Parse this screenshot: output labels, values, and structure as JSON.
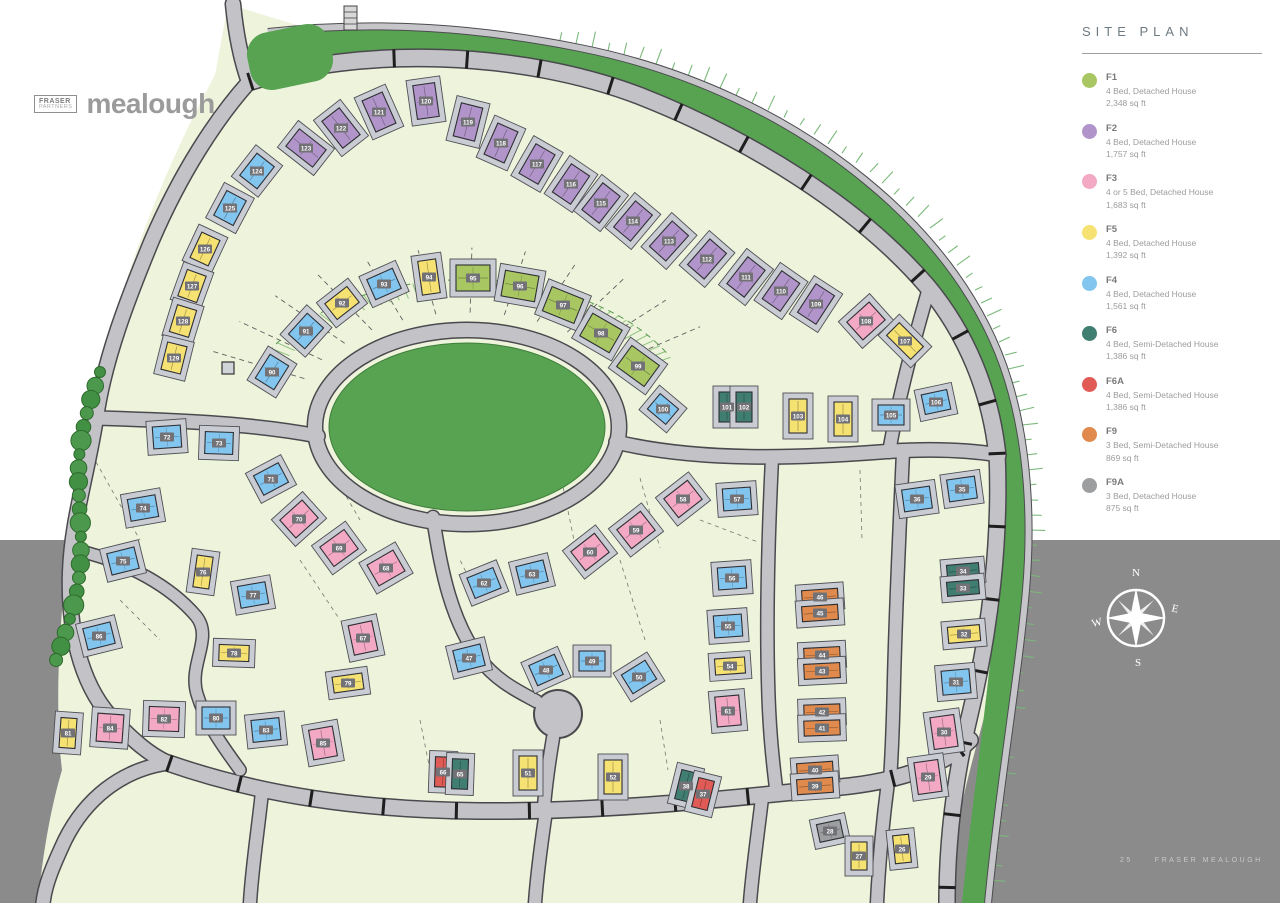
{
  "logo": {
    "box_line1": "FRASER",
    "box_line2": "PARTNERS",
    "name": "mealough"
  },
  "legend": {
    "title": "SITE PLAN",
    "items": [
      {
        "code": "F1",
        "desc": "4 Bed, Detached House",
        "area": "2,348 sq ft",
        "color": "#a8c763"
      },
      {
        "code": "F2",
        "desc": "4 Bed, Detached House",
        "area": "1,757 sq ft",
        "color": "#b195ca"
      },
      {
        "code": "F3",
        "desc": "4 or 5 Bed, Detached House",
        "area": "1,683 sq ft",
        "color": "#f3a9c4"
      },
      {
        "code": "F5",
        "desc": "4 Bed, Detached House",
        "area": "1,392 sq ft",
        "color": "#f6e273"
      },
      {
        "code": "F4",
        "desc": "4 Bed, Detached House",
        "area": "1,561 sq ft",
        "color": "#82c5ef"
      },
      {
        "code": "F6",
        "desc": "4 Bed, Semi-Detached House",
        "area": "1,386 sq ft",
        "color": "#417e72"
      },
      {
        "code": "F6A",
        "desc": "4 Bed, Semi-Detached House",
        "area": "1,386 sq ft",
        "color": "#e05b55"
      },
      {
        "code": "F9",
        "desc": "3 Bed, Semi-Detached House",
        "area": "869 sq ft",
        "color": "#e08b4d"
      },
      {
        "code": "F9A",
        "desc": "3 Bed, Detached House",
        "area": "875 sq ft",
        "color": "#9c9ea0"
      }
    ]
  },
  "compass": {
    "n": "N",
    "e": "E",
    "s": "S",
    "w": "W"
  },
  "footer": {
    "page": "25",
    "text": "FRASER MEALOUGH"
  },
  "colors": {
    "bg_white": "#ffffff",
    "bg_gray": "#8b8b8b",
    "land": "#eef3dc",
    "green": "#57a351",
    "road": "#c3c3c7",
    "road_casing": "#4a4a4e",
    "pad": "#c9cdd3",
    "badge": "#717176",
    "tree": "#4c984c"
  },
  "map": {
    "houses_format": [
      "plot_number",
      "type",
      "x",
      "y",
      "rotation_deg",
      "w_optional",
      "h_optional"
    ],
    "type_sizes": {
      "g": [
        34,
        26
      ],
      "p": [
        22,
        34
      ],
      "k": [
        30,
        24
      ],
      "y": [
        28,
        20
      ],
      "b": [
        28,
        22
      ],
      "t": [
        16,
        30
      ],
      "r": [
        16,
        30
      ],
      "o": [
        36,
        15
      ],
      "a": [
        24,
        18
      ]
    },
    "type_colors": {
      "g": "#a8c763",
      "p": "#b195ca",
      "k": "#f3a9c4",
      "y": "#f6e273",
      "b": "#82c5ef",
      "t": "#417e72",
      "r": "#e05b55",
      "o": "#e08b4d",
      "a": "#9c9ea0"
    },
    "houses": [
      [
        123,
        "p",
        306,
        148,
        -52
      ],
      [
        122,
        "p",
        341,
        128,
        -38
      ],
      [
        121,
        "p",
        379,
        112,
        -24
      ],
      [
        120,
        "p",
        426,
        101,
        -8
      ],
      [
        119,
        "p",
        468,
        122,
        14
      ],
      [
        118,
        "p",
        501,
        143,
        24
      ],
      [
        117,
        "p",
        537,
        164,
        30
      ],
      [
        116,
        "p",
        571,
        184,
        34
      ],
      [
        115,
        "p",
        601,
        203,
        38
      ],
      [
        114,
        "p",
        633,
        221,
        40
      ],
      [
        113,
        "p",
        669,
        241,
        42
      ],
      [
        112,
        "p",
        707,
        259,
        41
      ],
      [
        111,
        "p",
        746,
        277,
        38
      ],
      [
        110,
        "p",
        781,
        291,
        35
      ],
      [
        109,
        "p",
        816,
        304,
        33
      ],
      [
        124,
        "b",
        257,
        171,
        -52
      ],
      [
        125,
        "b",
        230,
        208,
        -62
      ],
      [
        126,
        "y",
        205,
        249,
        -65
      ],
      [
        127,
        "y",
        192,
        286,
        -70
      ],
      [
        128,
        "y",
        183,
        321,
        -73
      ],
      [
        129,
        "y",
        174,
        358,
        -76
      ],
      [
        90,
        "b",
        272,
        372,
        -58
      ],
      [
        91,
        "b",
        306,
        331,
        -48
      ],
      [
        92,
        "y",
        342,
        303,
        -38
      ],
      [
        93,
        "b",
        384,
        284,
        -24
      ],
      [
        94,
        "y",
        429,
        277,
        -8,
        18,
        34
      ],
      [
        95,
        "g",
        473,
        278,
        0
      ],
      [
        96,
        "g",
        520,
        286,
        10
      ],
      [
        97,
        "g",
        563,
        305,
        22
      ],
      [
        98,
        "g",
        601,
        333,
        30
      ],
      [
        99,
        "g",
        638,
        366,
        36
      ],
      [
        100,
        "b",
        663,
        409,
        40,
        24,
        20
      ],
      [
        101,
        "t",
        727,
        407,
        0
      ],
      [
        102,
        "t",
        744,
        407,
        0
      ],
      [
        103,
        "y",
        798,
        416,
        0,
        18,
        34
      ],
      [
        104,
        "y",
        843,
        419,
        0,
        18,
        34
      ],
      [
        105,
        "b",
        891,
        415,
        0,
        26,
        20
      ],
      [
        106,
        "b",
        936,
        402,
        -12,
        26,
        20
      ],
      [
        108,
        "k",
        866,
        321,
        -42
      ],
      [
        107,
        "y",
        905,
        341,
        -45,
        18,
        34
      ],
      [
        36,
        "b",
        917,
        499,
        -8
      ],
      [
        35,
        "b",
        962,
        489,
        -8
      ],
      [
        34,
        "t",
        963,
        571,
        -5,
        32,
        14
      ],
      [
        33,
        "t",
        963,
        588,
        -5,
        32,
        14
      ],
      [
        32,
        "y",
        964,
        634,
        -5,
        32,
        16
      ],
      [
        31,
        "b",
        956,
        682,
        -5,
        28,
        24
      ],
      [
        30,
        "k",
        944,
        732,
        -8,
        24,
        32
      ],
      [
        29,
        "k",
        928,
        777,
        -8,
        24,
        32
      ],
      [
        46,
        "o",
        820,
        597,
        -4
      ],
      [
        45,
        "o",
        820,
        613,
        -4
      ],
      [
        44,
        "o",
        822,
        655,
        -3
      ],
      [
        43,
        "o",
        822,
        671,
        -3
      ],
      [
        42,
        "o",
        822,
        712,
        -2
      ],
      [
        41,
        "o",
        822,
        728,
        -2
      ],
      [
        40,
        "o",
        815,
        770,
        -4
      ],
      [
        39,
        "o",
        815,
        786,
        -4
      ],
      [
        28,
        "a",
        830,
        831,
        -12
      ],
      [
        27,
        "y",
        859,
        856,
        0,
        16,
        28
      ],
      [
        26,
        "y",
        902,
        849,
        -6,
        16,
        28
      ],
      [
        57,
        "b",
        737,
        499,
        -4
      ],
      [
        56,
        "b",
        732,
        578,
        -4
      ],
      [
        55,
        "b",
        728,
        626,
        -4
      ],
      [
        54,
        "y",
        730,
        666,
        -4,
        30,
        16
      ],
      [
        60,
        "k",
        590,
        552,
        -38
      ],
      [
        59,
        "k",
        636,
        530,
        -38
      ],
      [
        58,
        "k",
        683,
        499,
        -38
      ],
      [
        61,
        "k",
        728,
        711,
        -5,
        24,
        30
      ],
      [
        62,
        "b",
        484,
        583,
        -22
      ],
      [
        63,
        "b",
        532,
        574,
        -14
      ],
      [
        72,
        "b",
        167,
        437,
        -4
      ],
      [
        73,
        "b",
        219,
        443,
        2
      ],
      [
        71,
        "b",
        271,
        479,
        -28
      ],
      [
        74,
        "b",
        143,
        508,
        -10
      ],
      [
        75,
        "b",
        123,
        561,
        -14
      ],
      [
        76,
        "y",
        203,
        572,
        8,
        16,
        32
      ],
      [
        77,
        "b",
        253,
        595,
        -10
      ],
      [
        70,
        "k",
        299,
        519,
        -42
      ],
      [
        69,
        "k",
        339,
        548,
        -36
      ],
      [
        68,
        "k",
        386,
        568,
        -30
      ],
      [
        67,
        "k",
        363,
        638,
        -12,
        24,
        30
      ],
      [
        47,
        "b",
        469,
        658,
        -14
      ],
      [
        48,
        "b",
        546,
        670,
        -24
      ],
      [
        49,
        "b",
        592,
        661,
        0,
        26,
        20
      ],
      [
        50,
        "b",
        639,
        677,
        -32
      ],
      [
        51,
        "y",
        528,
        773,
        0,
        18,
        34
      ],
      [
        52,
        "y",
        613,
        777,
        0,
        18,
        34
      ],
      [
        38,
        "t",
        686,
        786,
        14,
        16,
        30
      ],
      [
        37,
        "r",
        703,
        794,
        14,
        16,
        30
      ],
      [
        66,
        "r",
        443,
        772,
        2,
        16,
        30
      ],
      [
        65,
        "t",
        460,
        774,
        2,
        16,
        30
      ],
      [
        86,
        "b",
        99,
        636,
        -14
      ],
      [
        78,
        "y",
        234,
        653,
        2,
        30,
        16
      ],
      [
        79,
        "y",
        348,
        683,
        -8,
        30,
        16
      ],
      [
        81,
        "y",
        68,
        733,
        4,
        16,
        30
      ],
      [
        84,
        "k",
        110,
        728,
        4,
        26,
        28
      ],
      [
        82,
        "k",
        164,
        719,
        2,
        30,
        24
      ],
      [
        80,
        "b",
        216,
        718,
        0
      ],
      [
        83,
        "b",
        266,
        730,
        -6
      ],
      [
        85,
        "k",
        323,
        743,
        -10,
        24,
        30
      ]
    ]
  }
}
